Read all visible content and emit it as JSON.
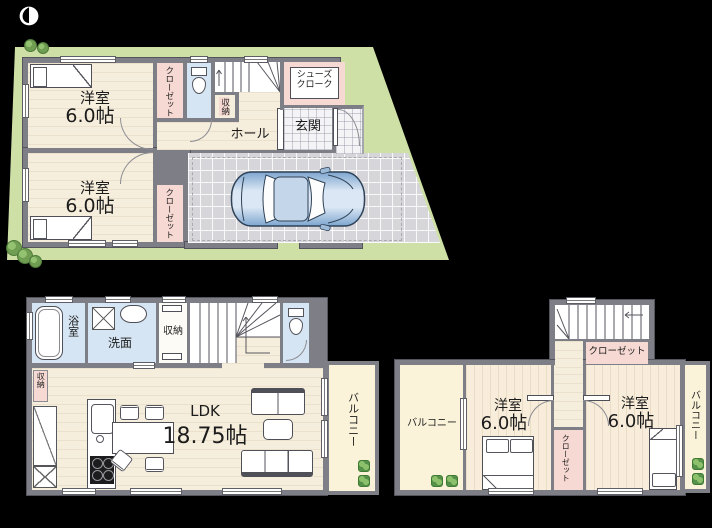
{
  "plan": {
    "type": "3-story house floor plan",
    "icons": [
      "north-arrow-icon",
      "car-icon",
      "bed-icon",
      "toilet-icon",
      "bathtub-icon",
      "sink-icon",
      "washer-icon",
      "stairs-icon",
      "sofa-icon",
      "dining-table-icon",
      "kitchen-icon",
      "plant-icon",
      "bush-icon"
    ],
    "colors": {
      "background": "#000000",
      "plot_green": "#cfe0a6",
      "wall_gray": "#7e7e86",
      "floor_cream": "#f6eedd",
      "wet_area_blue": "#d6e5f3",
      "closet_pink": "#f7d9d3",
      "balcony_cream": "#faf3da",
      "parking_gray": "#d6d6da",
      "car_blue": "#9dbad9"
    }
  },
  "floor1": {
    "bedroom_top": {
      "name": "洋室",
      "area": "6.0帖"
    },
    "bedroom_bottom": {
      "name": "洋室",
      "area": "6.0帖"
    },
    "closet_top": {
      "label": "クローゼット"
    },
    "closet_bottom": {
      "label": "クローゼット"
    },
    "storage": {
      "label": "収納"
    },
    "shoe_cloak": {
      "line1": "シューズ",
      "line2": "クローク"
    },
    "entrance": {
      "label": "玄関"
    },
    "hall": {
      "label": "ホール"
    }
  },
  "floor2": {
    "bath": {
      "label": "浴室"
    },
    "washroom": {
      "label": "洗面"
    },
    "storage": {
      "label": "収納"
    },
    "pantry": {
      "label": "収納"
    },
    "ldk": {
      "name": "LDK",
      "area": "18.75帖"
    },
    "balcony": {
      "label": "バルコニー"
    }
  },
  "floor3": {
    "stair_closet": {
      "label": "クローゼット"
    },
    "balcony_left": {
      "label": "バルコニー"
    },
    "bedroom_left": {
      "name": "洋室",
      "area": "6.0帖"
    },
    "closet_mid": {
      "label": "クローゼット"
    },
    "bedroom_right": {
      "name": "洋室",
      "area": "6.0帖"
    },
    "balcony_right": {
      "label": "バルコニー"
    }
  }
}
